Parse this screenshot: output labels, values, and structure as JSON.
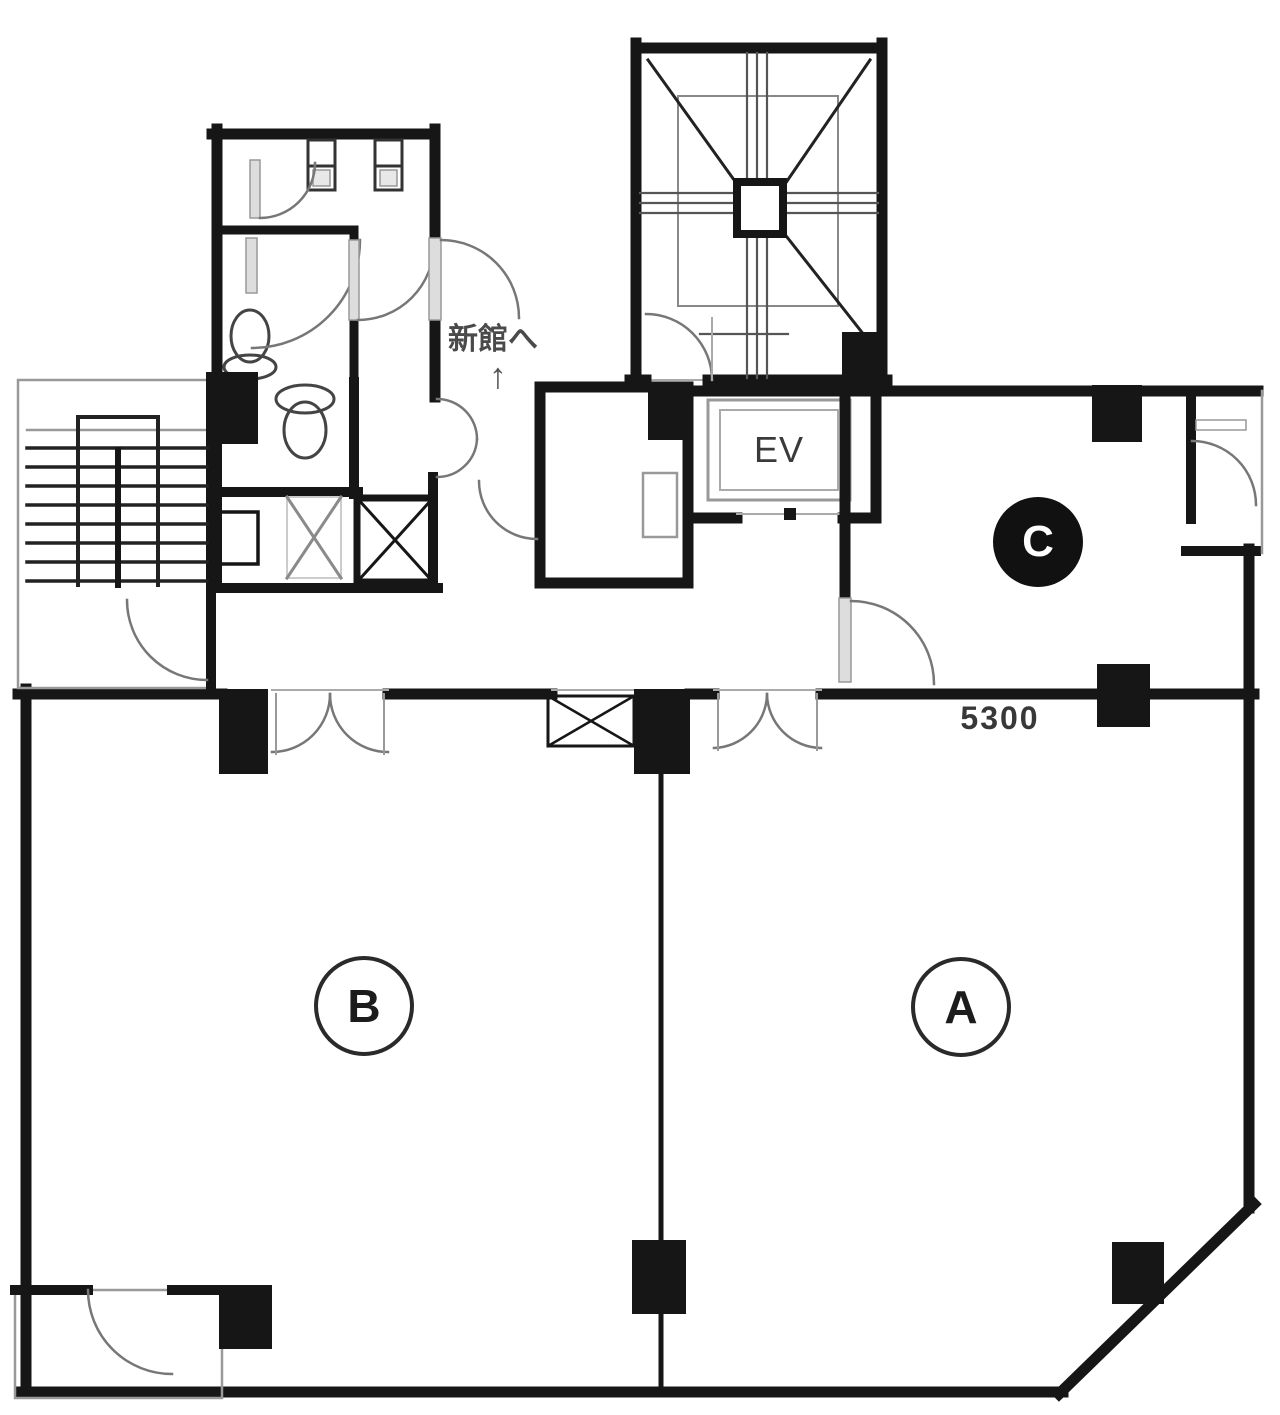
{
  "meta": {
    "type": "architectural-floor-plan",
    "background": "#ffffff",
    "wall_color": "#161616",
    "door_arc_color": "#777777"
  },
  "rooms": [
    {
      "id": "A",
      "label": "A",
      "style": "outlined-circle"
    },
    {
      "id": "B",
      "label": "B",
      "style": "outlined-circle"
    },
    {
      "id": "C",
      "label": "C",
      "style": "filled-circle"
    }
  ],
  "labels": {
    "elevator": "EV",
    "annotation_new_wing": "新館へ",
    "annotation_arrow": "↑",
    "dimension": "5300"
  }
}
